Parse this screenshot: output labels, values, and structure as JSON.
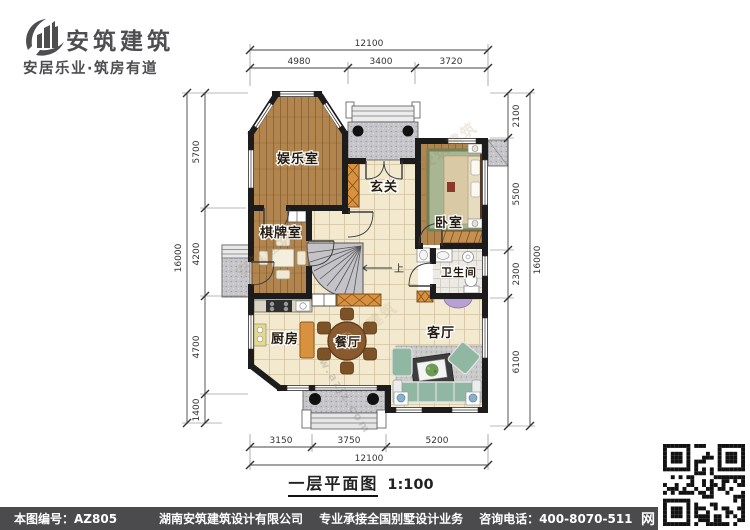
{
  "header": {
    "brand": "安筑建筑",
    "tagline": "安居乐业·筑房有道"
  },
  "plan": {
    "rooms": {
      "entertainment": "娱乐室",
      "chess": "棋牌室",
      "foyer": "玄关",
      "bedroom": "卧室",
      "bathroom": "卫生间",
      "kitchen": "厨房",
      "dining": "餐厅",
      "living": "客厅"
    },
    "stair_up": "上",
    "dims": {
      "top_total": "12100",
      "top_segs": [
        "4980",
        "3400",
        "3720"
      ],
      "bottom_segs": [
        "3150",
        "3750",
        "5200"
      ],
      "bottom_total": "12100",
      "left_segs": [
        "5700",
        "4200",
        "4700",
        "1400"
      ],
      "left_total": "16000",
      "right_segs": [
        "2100",
        "5500",
        "2300",
        "6100"
      ],
      "right_total": "16000"
    },
    "watermark": "安筑建筑",
    "watermark_url": "w.azjz.com"
  },
  "caption": {
    "title": "一层平面图",
    "scale": "1:100"
  },
  "footer": {
    "drawing_no": "本图编号：AZ805",
    "company": "湖南安筑建筑设计有限公司",
    "service": "专业承接全国别墅设计业务",
    "phone": "咨询电话：400-8070-511",
    "net_label": "网"
  },
  "colors": {
    "wall": "#1c1c1c",
    "wood": "#b2854e",
    "tile": "#f3e9cf",
    "porch": "#c6c6ca",
    "bar": "#4b4b4d",
    "cabinet": "#d8913f",
    "sofa": "#8fb7a2",
    "tv_stand": "#b7a0d4"
  }
}
